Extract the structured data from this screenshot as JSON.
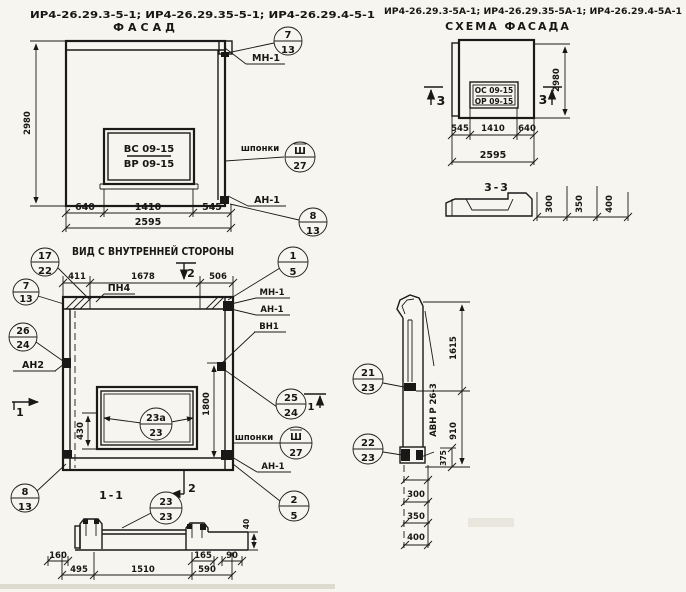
{
  "colors": {
    "ink": "#1b1a18",
    "paper": "#f7f5f0"
  },
  "header": {
    "left_codes": "ИР4-26.29.3-5-1; ИР4-26.29.35-5-1; ИР4-26.29.4-5-1",
    "right_codes": "ИР4-26.29.3-5А-1; ИР4-26.29.35-5А-1; ИР4-26.29.4-5А-1"
  },
  "facade": {
    "title": "ФАСАД",
    "window_mark_top": "ВС 09-15",
    "window_mark_bot": "ВР 09-15",
    "dim_height": "2980",
    "dim_b1": "640",
    "dim_b2": "1410",
    "dim_b3": "545",
    "dim_total": "2595",
    "c7_top": "7",
    "c7_bot": "13",
    "label_mn": "МН-1",
    "label_shponki": "шпонки",
    "csh_top": "Ш",
    "csh_bot": "27",
    "label_an": "АН-1",
    "c8_top": "8",
    "c8_bot": "13"
  },
  "scheme": {
    "title": "СХЕМА ФАСАДА",
    "window_mark_top": "ОС 09-15",
    "window_mark_bot": "ОР 09-15",
    "sec_left": "3",
    "sec_right": "3",
    "dim_height": "2980",
    "dim_b1": "545",
    "dim_b2": "1410",
    "dim_b3": "640",
    "dim_total": "2595"
  },
  "section33": {
    "title": "3-3",
    "d1": "300",
    "d2": "350",
    "d3": "400"
  },
  "inner": {
    "title": "ВИД С ВНУТРЕННЕЙ СТОРОНЫ",
    "dim_t1": "411",
    "dim_t2": "1678",
    "dim_t3": "506",
    "sec2": "2",
    "sec1": "1",
    "label_pn4": "ПН4",
    "c17_top": "17",
    "c17_bot": "22",
    "c1_top": "1",
    "c1_bot": "5",
    "c7_top": "7",
    "c7_bot": "13",
    "c26_top": "26",
    "c26_bot": "24",
    "label_an2": "АН2",
    "label_mn": "МН-1",
    "label_an": "АН-1",
    "label_vn": "ВН1",
    "c25_top": "25",
    "c25_bot": "24",
    "label_shponki": "шпонки",
    "csh_top": "Ш",
    "csh_bot": "27",
    "label_an_b": "АН-1",
    "c8_top": "8",
    "c8_bot": "13",
    "c2_top": "2",
    "c2_bot": "5",
    "c23a_top": "23а",
    "c23a_bot": "23",
    "dim_430": "430",
    "dim_1800": "1800"
  },
  "section11": {
    "title": "1-1",
    "c23_top": "23",
    "c23_bot": "23",
    "dim_40": "40",
    "du1": "160",
    "du2": "165",
    "du3": "90",
    "dl1": "495",
    "dl2": "1510",
    "dl3": "590"
  },
  "rightsec": {
    "c21_top": "21",
    "c21_bot": "23",
    "c22_top": "22",
    "c22_bot": "23",
    "label_avn": "АВН Р 26-3",
    "dim_1615": "1615",
    "dim_910": "910",
    "dim_375": "375",
    "d300": "300",
    "d350": "350",
    "d400": "400"
  }
}
